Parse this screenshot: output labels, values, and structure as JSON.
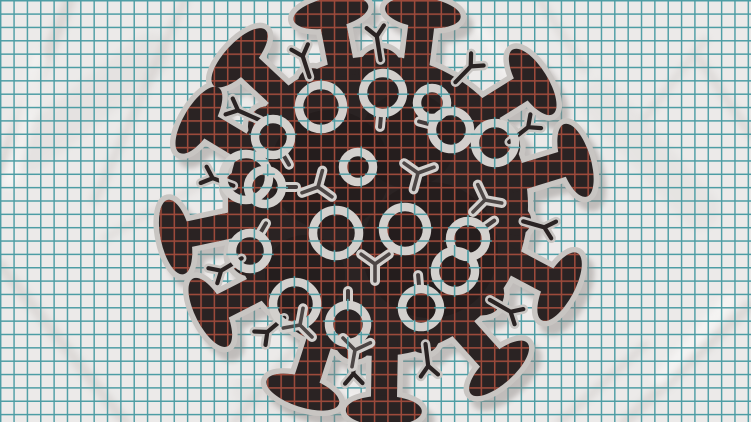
{
  "meta": {
    "title": "Coronavirus doodle on crumpled graph paper",
    "canvas_width": 751,
    "canvas_height": 422
  },
  "palette": {
    "paper": "#eceae9",
    "crease_shade": "#c9c3c0",
    "crease_light": "#fbfaf9",
    "grid_teal": "#4d9da4",
    "grid_red": "#9c4a3b",
    "virus_body": "#2a2323",
    "virus_shade": "#1d1818",
    "outline": "#c8c5c2",
    "protein": "#d3d0cd",
    "protein_core": "#2a2323",
    "shadow": "#8b8582"
  },
  "grid": {
    "spacing": 13.35,
    "offset": 0.7,
    "teal_width": 1.45,
    "red_width": 1.7,
    "tick_len": 12
  },
  "virus": {
    "cx": 378,
    "cy": 206,
    "r": 150,
    "spike": {
      "base_radius": 134,
      "stem_half_width": 13,
      "cap_rx": 38,
      "cap_ry": 15
    },
    "spikes": [
      {
        "a": -157,
        "t": 8,
        "len": 30
      },
      {
        "a": -131,
        "t": -6,
        "len": 34
      },
      {
        "a": -105,
        "t": 4,
        "len": 30
      },
      {
        "a": -74,
        "t": -9,
        "len": 30
      },
      {
        "a": -42,
        "t": 10,
        "len": 30
      },
      {
        "a": -11,
        "t": -6,
        "len": 34
      },
      {
        "a": 22,
        "t": 6,
        "len": 30
      },
      {
        "a": 56,
        "t": -8,
        "len": 34
      },
      {
        "a": 87,
        "t": 4,
        "len": 36
      },
      {
        "a": 114,
        "t": -6,
        "len": 32
      },
      {
        "a": 145,
        "t": 8,
        "len": 30
      },
      {
        "a": 173,
        "t": -5,
        "len": 36
      }
    ],
    "small_spikes": [
      {
        "a": -144,
        "t": -12,
        "len": 24
      },
      {
        "a": -118,
        "t": 10,
        "len": 22
      },
      {
        "a": -89,
        "t": -10,
        "len": 24
      },
      {
        "a": -58,
        "t": 12,
        "len": 22
      },
      {
        "a": -26,
        "t": -12,
        "len": 24
      },
      {
        "a": 6,
        "t": 10,
        "len": 22
      },
      {
        "a": 40,
        "t": -10,
        "len": 24
      },
      {
        "a": 71,
        "t": 12,
        "len": 22
      },
      {
        "a": 100,
        "t": -12,
        "len": 24
      },
      {
        "a": 130,
        "t": 10,
        "len": 22
      },
      {
        "a": 159,
        "t": -10,
        "len": 24
      },
      {
        "a": -172,
        "t": 12,
        "len": 22
      }
    ],
    "bumps": [
      {
        "a": -144,
        "rad": 136,
        "r": 20
      },
      {
        "a": -89,
        "rad": 136,
        "r": 22
      },
      {
        "a": -26,
        "rad": 136,
        "r": 20
      },
      {
        "a": 40,
        "rad": 136,
        "r": 22
      },
      {
        "a": 100,
        "rad": 136,
        "r": 20
      },
      {
        "a": 159,
        "rad": 136,
        "r": 22
      },
      {
        "a": -172,
        "rad": 139,
        "r": 16
      },
      {
        "a": 71,
        "rad": 139,
        "r": 16
      },
      {
        "a": -118,
        "rad": 139,
        "r": 15
      },
      {
        "a": 6,
        "rad": 139,
        "r": 15
      }
    ],
    "shading": [
      {
        "x": 330,
        "y": 170,
        "r": 60,
        "o": 0.5
      },
      {
        "x": 430,
        "y": 250,
        "r": 68,
        "o": 0.5
      },
      {
        "x": 305,
        "y": 275,
        "r": 40,
        "o": 0.45
      },
      {
        "x": 408,
        "y": 140,
        "r": 48,
        "o": 0.35
      }
    ],
    "proteins": [
      {
        "type": "ring",
        "x": 321,
        "y": 107,
        "r": 22
      },
      {
        "type": "ring",
        "x": 246,
        "y": 177,
        "r": 23
      },
      {
        "type": "ring",
        "x": 358,
        "y": 167,
        "r": 15
      },
      {
        "type": "ring",
        "x": 432,
        "y": 103,
        "r": 15
      },
      {
        "type": "ring",
        "x": 495,
        "y": 143,
        "r": 20
      },
      {
        "type": "ring",
        "x": 336,
        "y": 233,
        "r": 23
      },
      {
        "type": "ring",
        "x": 405,
        "y": 229,
        "r": 22
      },
      {
        "type": "ring",
        "x": 295,
        "y": 304,
        "r": 22
      },
      {
        "type": "ring",
        "x": 455,
        "y": 271,
        "r": 20
      },
      {
        "type": "keyhole",
        "x": 383,
        "y": 93,
        "r": 20,
        "dir": 95
      },
      {
        "type": "keyhole",
        "x": 273,
        "y": 137,
        "r": 18,
        "dir": 60
      },
      {
        "type": "keyhole",
        "x": 451,
        "y": 130,
        "r": 19,
        "dir": 195
      },
      {
        "type": "keyhole",
        "x": 265,
        "y": 187,
        "r": 17,
        "dir": 0
      },
      {
        "type": "keyhole",
        "x": 250,
        "y": 251,
        "r": 18,
        "dir": -60
      },
      {
        "type": "keyhole",
        "x": 348,
        "y": 324,
        "r": 19,
        "dir": -90
      },
      {
        "type": "keyhole",
        "x": 421,
        "y": 308,
        "r": 19,
        "dir": -95
      },
      {
        "type": "keyhole",
        "x": 468,
        "y": 239,
        "r": 18,
        "dir": -35
      },
      {
        "type": "y",
        "x": 418,
        "y": 173,
        "dir": -20
      },
      {
        "type": "y",
        "x": 318,
        "y": 187,
        "dir": 160
      },
      {
        "type": "y",
        "x": 375,
        "y": 264,
        "dir": 90
      },
      {
        "type": "y",
        "x": 300,
        "y": 325,
        "dir": 45
      },
      {
        "type": "y",
        "x": 355,
        "y": 350,
        "dir": 100
      },
      {
        "type": "y",
        "x": 485,
        "y": 200,
        "dir": 10
      }
    ]
  },
  "creases": [
    {
      "x1": 70,
      "y1": 0,
      "x2": 0,
      "y2": 170,
      "w": 12,
      "kind": "shade",
      "o": 0.5
    },
    {
      "x1": 185,
      "y1": 0,
      "x2": 95,
      "y2": 200,
      "w": 9,
      "kind": "shade",
      "o": 0.4
    },
    {
      "x1": 0,
      "y1": 265,
      "x2": 125,
      "y2": 422,
      "w": 11,
      "kind": "shade",
      "o": 0.45
    },
    {
      "x1": 235,
      "y1": 422,
      "x2": 330,
      "y2": 305,
      "w": 9,
      "kind": "shade",
      "o": 0.4
    },
    {
      "x1": 560,
      "y1": 422,
      "x2": 645,
      "y2": 345,
      "w": 9,
      "kind": "shade",
      "o": 0.4
    },
    {
      "x1": 751,
      "y1": 305,
      "x2": 625,
      "y2": 422,
      "w": 11,
      "kind": "shade",
      "o": 0.45
    },
    {
      "x1": 700,
      "y1": 60,
      "x2": 751,
      "y2": 135,
      "w": 9,
      "kind": "shade",
      "o": 0.4
    },
    {
      "x1": 540,
      "y1": 0,
      "x2": 585,
      "y2": 70,
      "w": 8,
      "kind": "shade",
      "o": 0.35
    },
    {
      "x1": 645,
      "y1": 118,
      "x2": 705,
      "y2": 40,
      "w": 8,
      "kind": "shade",
      "o": 0.35
    },
    {
      "x1": 105,
      "y1": 238,
      "x2": 205,
      "y2": 182,
      "w": 8,
      "kind": "shade",
      "o": 0.3
    },
    {
      "x1": 30,
      "y1": 150,
      "x2": 150,
      "y2": 55,
      "w": 44,
      "kind": "shade",
      "o": 0.18
    },
    {
      "x1": 600,
      "y1": 100,
      "x2": 700,
      "y2": 210,
      "w": 40,
      "kind": "shade",
      "o": 0.15
    },
    {
      "x1": 250,
      "y1": 390,
      "x2": 420,
      "y2": 418,
      "w": 36,
      "kind": "shade",
      "o": 0.15
    },
    {
      "x1": 40,
      "y1": 60,
      "x2": 10,
      "y2": 180,
      "w": 16,
      "kind": "light",
      "o": 0.6
    },
    {
      "x1": 660,
      "y1": 380,
      "x2": 730,
      "y2": 300,
      "w": 14,
      "kind": "light",
      "o": 0.6
    },
    {
      "x1": 480,
      "y1": 28,
      "x2": 520,
      "y2": 88,
      "w": 10,
      "kind": "light",
      "o": 0.55
    },
    {
      "x1": 200,
      "y1": 120,
      "x2": 260,
      "y2": 60,
      "w": 10,
      "kind": "light",
      "o": 0.5
    },
    {
      "x1": 340,
      "y1": 395,
      "x2": 430,
      "y2": 410,
      "w": 12,
      "kind": "light",
      "o": 0.5
    }
  ]
}
